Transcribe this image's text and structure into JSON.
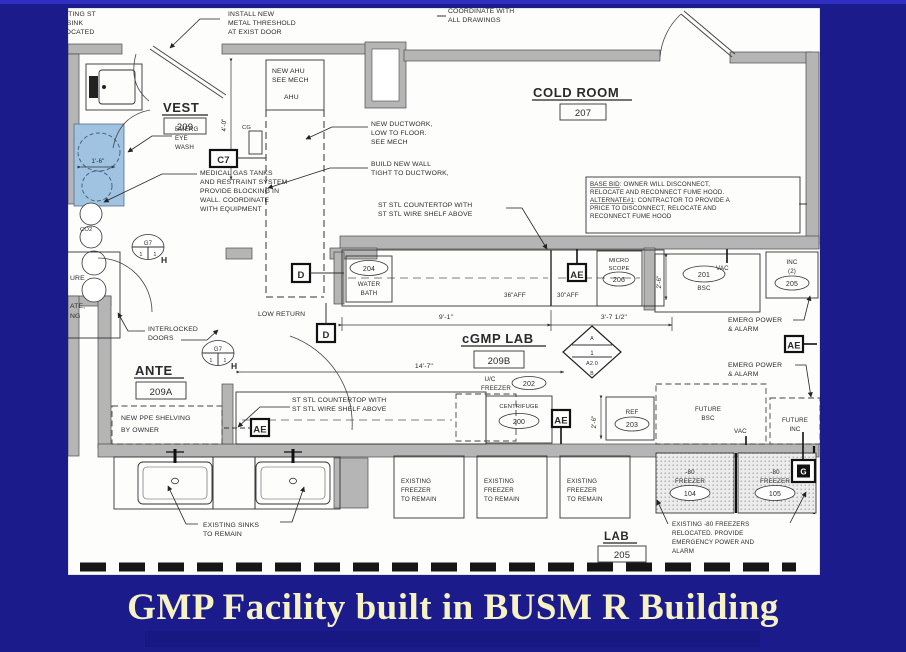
{
  "slide": {
    "title": "GMP Facility built in BUSM R Building",
    "title_color": "#f6f2c4",
    "bg_color": "#1b1b8c",
    "accent_line_color": "#2e2ec0"
  },
  "rooms": {
    "vest": {
      "name": "VEST",
      "number": "209"
    },
    "cold_room": {
      "name": "COLD ROOM",
      "number": "207"
    },
    "cgmp_lab": {
      "name": "cGMP LAB",
      "number": "209B"
    },
    "ante": {
      "name": "ANTE",
      "number": "209A"
    },
    "lab": {
      "name": "LAB",
      "number": "205"
    }
  },
  "equipment": {
    "water_bath": {
      "tag": "204",
      "line1": "WATER",
      "line2": "BATH"
    },
    "microscope": {
      "tag": "206",
      "line1": "MICRO",
      "line2": "SCOPE"
    },
    "bsc": {
      "tag": "201",
      "label": "BSC"
    },
    "incubator": {
      "tag": "205",
      "line1": "INC",
      "line2": "(2)"
    },
    "uc_freezer": {
      "tag": "202",
      "line1": "U/C",
      "line2": "FREEZER"
    },
    "centrifuge": {
      "tag": "200",
      "label": "CENTRIFUGE"
    },
    "ref": {
      "tag": "203",
      "label": "REF"
    },
    "future_bsc": {
      "line1": "FUTURE",
      "line2": "BSC"
    },
    "future_inc": {
      "line1": "FUTURE",
      "line2": "INC"
    },
    "freezer_104": {
      "tag": "104",
      "line1": "-80",
      "line2": "FREEZER"
    },
    "freezer_105": {
      "tag": "105",
      "line1": "-80",
      "line2": "FREEZER"
    }
  },
  "notes": {
    "sink_relocated": [
      "EXISTING ST",
      "STL SINK",
      "RELOCATED"
    ],
    "threshold": [
      "INSTALL NEW",
      "METAL THRESHOLD",
      "AT EXIST DOOR"
    ],
    "coordinate": [
      "COORDINATE WITH",
      "ALL DRAWINGS"
    ],
    "new_ahu": [
      "NEW AHU",
      "SEE MECH"
    ],
    "ahu": "AHU",
    "eye_wash": [
      "EMERG",
      "EYE",
      "WASH"
    ],
    "medical_gas": [
      "MEDICAL GAS TANKS",
      "AND RESTRAINT SYSTEM",
      "PROVIDE BLOCKING IN",
      "WALL.  COORDINATE",
      "WITH EQUIPMENT"
    ],
    "new_ductwork": [
      "NEW DUCTWORK,",
      "LOW TO FLOOR.",
      "SEE MECH"
    ],
    "build_wall": [
      "BUILD NEW WALL",
      "TIGHT TO DUCTWORK,"
    ],
    "countertop": [
      "ST STL COUNTERTOP WITH",
      "ST STL WIRE SHELF ABOVE"
    ],
    "base_bid": [
      "BASE BID: OWNER WILL DISCONNECT,",
      "RELOCATE AND RECONNECT FUME HOOD.",
      "ALTERNATE#1: CONTRACTOR TO PROVIDE A",
      "PRICE TO DISCONNECT, RELOCATE AND",
      "RECONNECT FUME HOOD"
    ],
    "interlocked": [
      "INTERLOCKED",
      "DOORS"
    ],
    "low_return": "LOW RETURN",
    "ppe_shelving": [
      "NEW PPE SHELVING",
      "BY OWNER"
    ],
    "sinks_remain": [
      "EXISTING SINKS",
      "TO REMAIN"
    ],
    "freezer_remain": [
      "EXISTING",
      "FREEZER",
      "TO REMAIN"
    ],
    "freezers_relocated": [
      "EXISTING -80 FREEZERS",
      "RELOCATED.  PROVIDE",
      "EMERGENCY POWER AND",
      "ALARM"
    ],
    "emerg_power": [
      "EMERG POWER",
      "& ALARM"
    ],
    "co2": "CO2",
    "clipped_left": [
      "URE",
      "ATE,",
      "NG"
    ]
  },
  "dimensions": {
    "vest_height": "4'-0\"",
    "shower_width": "1'-6\"",
    "counter_left": "9'-1\"",
    "counter_right": "3'-7 1/2\"",
    "lab_width": "14'-7\"",
    "bsc_depth": "2'-6\"",
    "ref_depth": "2'-6\"",
    "aff_36": "36\"AFF",
    "aff_30": "30\"AFF"
  },
  "markers": {
    "c7": "C7",
    "d": "D",
    "ae": "AE",
    "g": "G",
    "g7": "G7",
    "h": "H",
    "one": "1",
    "cg": "CG",
    "vac": "VAC",
    "section_top": "A",
    "section_num": "1",
    "section_sheet": "A2.0",
    "section_bottom": "B"
  }
}
